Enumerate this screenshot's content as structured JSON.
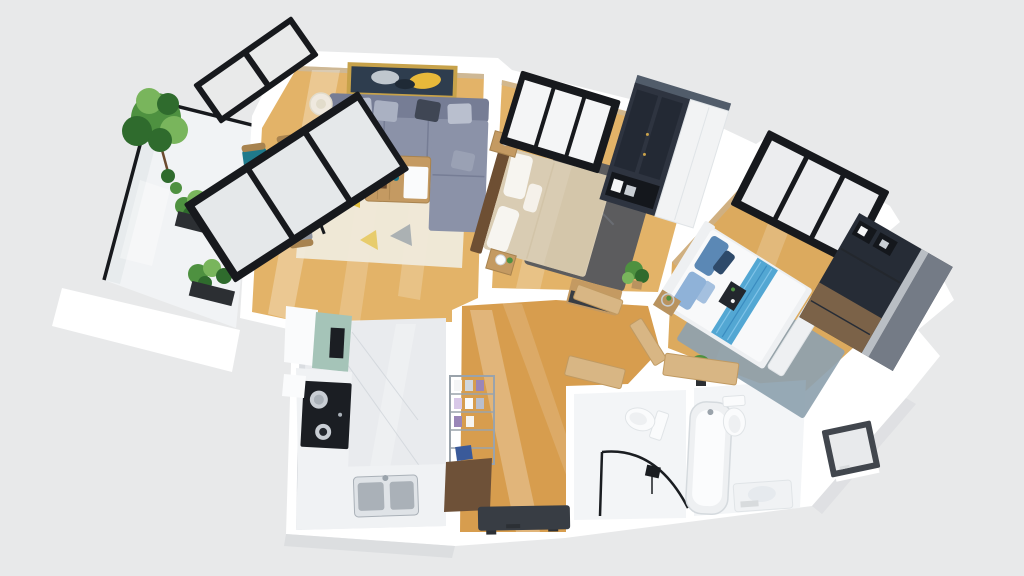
{
  "meta": {
    "description": "3D axonometric rendering of a two-bedroom apartment floor plan with living-dining room, kitchen, hallway, two bathrooms and a planted balcony",
    "canvas": {
      "width": 1024,
      "height": 576
    }
  },
  "rooms": [
    {
      "name": "balcony",
      "floor": "white-stone",
      "contents": [
        "glass-railing",
        "tree",
        "planter-boxes"
      ]
    },
    {
      "name": "living-dining-room",
      "floor": "light-wood",
      "contents": [
        "sectional-sofa",
        "coffee-table",
        "wall-art",
        "floor-lamp",
        "side-table",
        "dining-table",
        "four-chairs",
        "patterned-rug",
        "balcony-glass-doors"
      ]
    },
    {
      "name": "bedroom-1",
      "floor": "light-wood",
      "contents": [
        "double-bed-beige",
        "charcoal-rug",
        "black-frame-window",
        "wardrobe-glass-and-white",
        "two-nightstands",
        "console",
        "plant"
      ]
    },
    {
      "name": "bedroom-2",
      "floor": "light-wood",
      "contents": [
        "double-bed-white-blue",
        "bench",
        "blue-gray-rug",
        "black-frame-window",
        "dark-wardrobe-desk",
        "nightstand",
        "plant"
      ]
    },
    {
      "name": "kitchen",
      "floor": "marble",
      "contents": [
        "tall-white-cabinet",
        "mint-upper-cabinet",
        "black-cooktop",
        "double-sink",
        "l-counter"
      ]
    },
    {
      "name": "hallway",
      "floor": "wood",
      "contents": [
        "shoe-rack",
        "wood-cabinet",
        "entry-mat",
        "open-doors"
      ]
    },
    {
      "name": "bathroom-1",
      "floor": "white-marble",
      "contents": [
        "toilet",
        "corner-shower-black-frame"
      ]
    },
    {
      "name": "bathroom-2",
      "floor": "white-marble",
      "contents": [
        "bathtub",
        "toilet",
        "vanity",
        "small-window"
      ]
    }
  ],
  "colors": {
    "bg": "#e8e9ea",
    "wallWhite": "#ffffff",
    "wallShade": "#d8dbdd",
    "innerShadow": "#b9bec2",
    "woodLight": "#e3b368",
    "woodMid": "#dcaa5e",
    "woodDark": "#d79d4e",
    "marbleBalcony": "#f1f3f5",
    "marbleKitchen": "#e9ebee",
    "marbleVein": "#cfd4d9",
    "bathFloor": "#f3f5f7",
    "frameBlack": "#17191d",
    "glassLight": "#f4f5f6",
    "glassMarble": "#eef0f2",
    "railGlass": "#dfe4e6",
    "sofaBody": "#8b92a8",
    "sofaBack": "#767d95",
    "sofaPillowLight": "#b9bfce",
    "sofaPillowMid": "#aab1c2",
    "sofaPillowDark": "#3f4654",
    "chaisePillow": "#9aa1b4",
    "rugCream": "#efe9da",
    "rugYellow": "#e4c13f",
    "rugGray": "#9aa2aa",
    "artFrame": "#c7a24a",
    "artCanvas": "#2e3d4e",
    "artAccent": "#e8b93a",
    "artLight": "#cfd6dd",
    "artDark": "#1f2a36",
    "tableWood": "#c49a62",
    "tableWoodEdge": "#a8834f",
    "chairTeal": "#1f7a8c",
    "chairGreen": "#6da32f",
    "chairGray": "#979ca6",
    "chairGrayDark": "#8f949e",
    "lampShade": "#efe9df",
    "lampInner": "#e2dccb",
    "bedBeige": "#d9ccb3",
    "bedBeigeFold": "#d2c4a8",
    "bedHeadboard": "#6e4f33",
    "pillowWhite": "#f7f5f0",
    "rugCharcoal": "#56585e",
    "rugCharcoalLine": "#6a6d73",
    "wardrobeDark": "#2e3440",
    "wardrobeGlass": "#222833",
    "wardrobeTop": "#515c6a",
    "wardrobeWhite": "#f2f3f4",
    "goldHandle": "#caa24a",
    "bedWhite": "#f8f9fa",
    "bedFrameLight": "#eef0f2",
    "runnerBlue": "#53a7d3",
    "runnerLight": "#7fc3e8",
    "runnerDark": "#3a8cc0",
    "pillowBlue": "#5b88b5",
    "pillowBlueLight": "#8fb2d8",
    "pillowNavy": "#2e4a6a",
    "trayBlack": "#23272d",
    "rugBlueGray": "#8ea2af",
    "wardrobe2Dark": "#262c36",
    "wardrobe2Top": "#747b86",
    "wardrobe2Band": "#b9bec4",
    "wardrobe2Wood": "#7b6248",
    "cubeDark": "#14171c",
    "mint": "#a5c4b8",
    "stoveBlack": "#1b1e23",
    "steel": "#c9ced4",
    "steelDark": "#aab1b8",
    "counterWhite": "#f0f2f4",
    "sinkBody": "#dfe3e7",
    "fixtureWhite": "#fafbfc",
    "fixtureStroke": "#e0e4e7",
    "rackSteel": "#9aa3ab",
    "itemPurple": "#9a86b8",
    "itemLav": "#d8c8e8",
    "itemBlue": "#3a5a9a",
    "shoeCabinet": "#6e5138",
    "matCharcoal": "#383d44",
    "matFoot": "#2c3035",
    "showerFrame": "#1a1d21",
    "tubInner": "#fbfcfd",
    "tubStroke": "#d5dade",
    "basinGray": "#e6eaee",
    "doorWood": "#d8b684",
    "doorWoodEdge": "#c09a62",
    "plantDark": "#2f6b2d",
    "plantMid": "#4e9140",
    "plantLight": "#79b55c",
    "planterDark": "#2c2f33",
    "potWood": "#b9935f",
    "trunk": "#6b4a2e",
    "smallWinFrame": "#41464d",
    "smallWinPane": "#e8eaec",
    "lightStreak": "#ffffff"
  }
}
